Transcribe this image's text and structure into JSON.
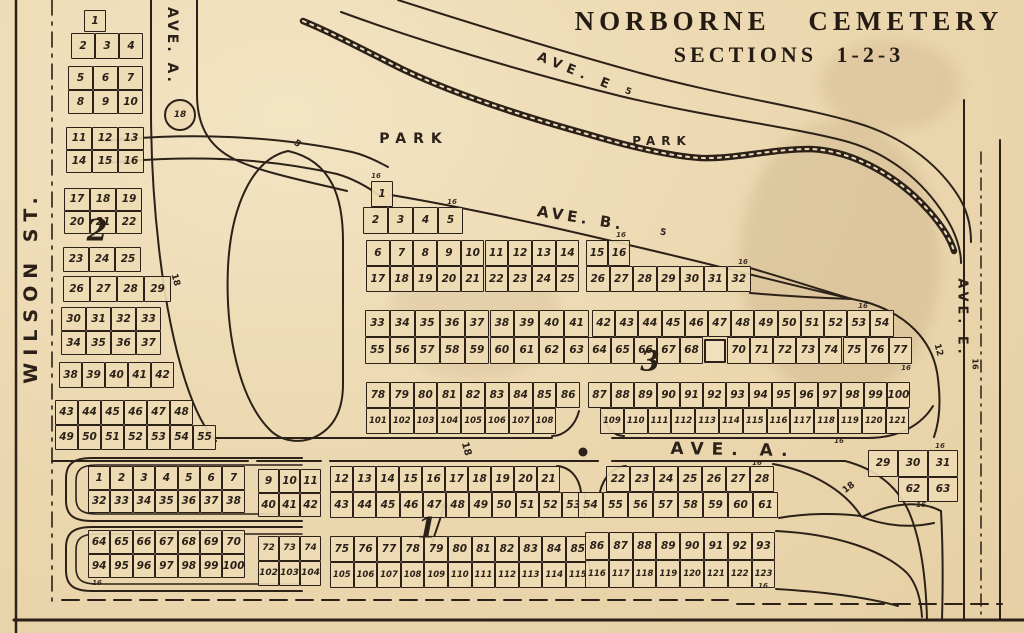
{
  "title": {
    "line1": "NORBORNE CEMETERY",
    "line2": "SECTIONS 1-2-3"
  },
  "colors": {
    "paper": "#ecd8b0",
    "ink": "#2b2118"
  },
  "markers": {
    "circle18": "18"
  },
  "labels": [
    {
      "id": "wilson-st-label",
      "text": "WILSON ST.",
      "x": 31,
      "y": 287,
      "rot": -90,
      "fs": 19,
      "ls": 7
    },
    {
      "id": "ave-a-north-label",
      "text": "AVE. A.",
      "x": 172,
      "y": 46,
      "rot": 90,
      "fs": 14,
      "ls": 3
    },
    {
      "id": "ave-e-top-label",
      "text": "AVE. E",
      "x": 576,
      "y": 72,
      "rot": 22,
      "fs": 13,
      "ls": 6
    },
    {
      "id": "ave-e-top-width",
      "text": "5",
      "x": 628,
      "y": 92,
      "rot": 22,
      "fs": 9
    },
    {
      "id": "park-west-label",
      "text": "PARK",
      "x": 414,
      "y": 139,
      "rot": 0,
      "fs": 14,
      "ls": 7
    },
    {
      "id": "park-east-label",
      "text": "PARK",
      "x": 662,
      "y": 141,
      "rot": 0,
      "fs": 12,
      "ls": 6
    },
    {
      "id": "ave-b-label",
      "text": "AVE. B.",
      "x": 581,
      "y": 218,
      "rot": 9,
      "fs": 15,
      "ls": 4
    },
    {
      "id": "ave-b-width",
      "text": "5",
      "x": 663,
      "y": 233,
      "rot": 12,
      "fs": 9
    },
    {
      "id": "park-road-width",
      "text": "5",
      "x": 297,
      "y": 144,
      "rot": 35,
      "fs": 9
    },
    {
      "id": "ave-a-main-label",
      "text": "AVE.  A.",
      "x": 733,
      "y": 450,
      "rot": 1,
      "fs": 17,
      "ls": 8
    },
    {
      "id": "ave-e-right-label",
      "text": "AVE. E.",
      "x": 962,
      "y": 318,
      "rot": 90,
      "fs": 13,
      "ls": 4
    },
    {
      "id": "ave-e-right-width",
      "text": "16",
      "x": 975,
      "y": 364,
      "rot": 90,
      "fs": 8
    },
    {
      "id": "road-width-18-left",
      "text": "18",
      "x": 175,
      "y": 280,
      "rot": 75,
      "fs": 9
    },
    {
      "id": "road-width-18-avea",
      "text": "18",
      "x": 466,
      "y": 449,
      "rot": 75,
      "fs": 10
    },
    {
      "id": "road-width-18-se",
      "text": "18",
      "x": 849,
      "y": 488,
      "rot": -38,
      "fs": 9
    },
    {
      "id": "road-width-12-right",
      "text": "12",
      "x": 938,
      "y": 350,
      "rot": 75,
      "fs": 9
    },
    {
      "id": "section-2-numeral",
      "text": "2",
      "x": 97,
      "y": 231,
      "rot": 0,
      "fs": 30,
      "cls": "numeral"
    },
    {
      "id": "section-3-numeral",
      "text": "3",
      "x": 650,
      "y": 361,
      "rot": 0,
      "fs": 28,
      "cls": "numeral"
    },
    {
      "id": "section-1-numeral",
      "text": "1",
      "x": 427,
      "y": 528,
      "rot": 0,
      "fs": 28,
      "cls": "numeral"
    },
    {
      "id": "lot-width-tick",
      "text": "16",
      "x": 376,
      "y": 176,
      "rot": 0,
      "fs": 7,
      "cls": "tick"
    },
    {
      "id": "lot-width-tick",
      "text": "16",
      "x": 452,
      "y": 202,
      "rot": 0,
      "fs": 7,
      "cls": "tick"
    },
    {
      "id": "lot-width-tick",
      "text": "16",
      "x": 621,
      "y": 235,
      "rot": 0,
      "fs": 7,
      "cls": "tick"
    },
    {
      "id": "lot-width-tick",
      "text": "16",
      "x": 743,
      "y": 262,
      "rot": 0,
      "fs": 7,
      "cls": "tick"
    },
    {
      "id": "lot-width-tick",
      "text": "16",
      "x": 863,
      "y": 306,
      "rot": 0,
      "fs": 7,
      "cls": "tick"
    },
    {
      "id": "lot-width-tick",
      "text": "16",
      "x": 906,
      "y": 368,
      "rot": 0,
      "fs": 7,
      "cls": "tick"
    },
    {
      "id": "lot-width-tick",
      "text": "16",
      "x": 839,
      "y": 441,
      "rot": 0,
      "fs": 7,
      "cls": "tick"
    },
    {
      "id": "lot-width-tick",
      "text": "16",
      "x": 757,
      "y": 463,
      "rot": 0,
      "fs": 7,
      "cls": "tick"
    },
    {
      "id": "lot-width-tick",
      "text": "16",
      "x": 940,
      "y": 446,
      "rot": 0,
      "fs": 7,
      "cls": "tick"
    },
    {
      "id": "lot-width-tick",
      "text": "16",
      "x": 921,
      "y": 505,
      "rot": 0,
      "fs": 7,
      "cls": "tick"
    },
    {
      "id": "lot-width-tick",
      "text": "16",
      "x": 763,
      "y": 586,
      "rot": 0,
      "fs": 7,
      "cls": "tick"
    },
    {
      "id": "lot-width-tick",
      "text": "16",
      "x": 97,
      "y": 583,
      "rot": 0,
      "fs": 7,
      "cls": "tick"
    }
  ],
  "grids": [
    {
      "id": "sec2-block-a",
      "x": 84,
      "y": 10,
      "cw": 22,
      "ch": 22,
      "rows": [
        [
          "1"
        ]
      ]
    },
    {
      "id": "sec2-block-b",
      "x": 71,
      "y": 33,
      "cw": 24,
      "ch": 26,
      "rows": [
        [
          "2",
          "3",
          "4"
        ]
      ]
    },
    {
      "id": "sec2-block-c",
      "x": 68,
      "y": 66,
      "cw": 25,
      "ch": 24,
      "rows": [
        [
          "5",
          "6",
          "7"
        ],
        [
          "8",
          "9",
          "10"
        ]
      ]
    },
    {
      "id": "sec2-block-d",
      "x": 66,
      "y": 127,
      "cw": 26,
      "ch": 23,
      "rows": [
        [
          "11",
          "12",
          "13"
        ],
        [
          "14",
          "15",
          "16"
        ]
      ]
    },
    {
      "id": "sec2-block-e",
      "x": 64,
      "y": 188,
      "cw": 26,
      "ch": 23,
      "rows": [
        [
          "17",
          "18",
          "19"
        ],
        [
          "20",
          "21",
          "22"
        ]
      ]
    },
    {
      "id": "sec2-block-f",
      "x": 63,
      "y": 247,
      "cw": 26,
      "ch": 25,
      "rows": [
        [
          "23",
          "24",
          "25"
        ]
      ]
    },
    {
      "id": "sec2-block-g",
      "x": 63,
      "y": 276,
      "cw": 27,
      "ch": 26,
      "rows": [
        [
          "26",
          "27",
          "28",
          "29"
        ]
      ]
    },
    {
      "id": "sec2-block-h",
      "x": 61,
      "y": 307,
      "cw": 25,
      "ch": 24,
      "rows": [
        [
          "30",
          "31",
          "32",
          "33"
        ],
        [
          "34",
          "35",
          "36",
          "37"
        ]
      ]
    },
    {
      "id": "sec2-block-i",
      "x": 59,
      "y": 362,
      "cw": 23,
      "ch": 26,
      "rows": [
        [
          "38",
          "39",
          "40",
          "41",
          "42"
        ]
      ]
    },
    {
      "id": "sec2-block-j",
      "x": 55,
      "y": 400,
      "cw": 23,
      "ch": 25,
      "rows": [
        [
          "43",
          "44",
          "45",
          "46",
          "47",
          "48"
        ]
      ]
    },
    {
      "id": "sec2-block-k",
      "x": 55,
      "y": 425,
      "cw": 23,
      "ch": 25,
      "rows": [
        [
          "49",
          "50",
          "51",
          "52",
          "53",
          "54",
          "55"
        ]
      ]
    },
    {
      "id": "sec3-lot-1",
      "x": 371,
      "y": 181,
      "cw": 22,
      "ch": 26,
      "rows": [
        [
          "1"
        ]
      ]
    },
    {
      "id": "sec3-row-2-5",
      "x": 363,
      "y": 207,
      "cw": 25,
      "ch": 27,
      "rows": [
        [
          "2",
          "3",
          "4",
          "5"
        ]
      ]
    },
    {
      "id": "sec3-band1-left",
      "x": 366,
      "y": 240,
      "cw": 23.7,
      "ch": 26,
      "rows": [
        [
          "6",
          "7",
          "8",
          "9",
          "10",
          "11",
          "12",
          "13",
          "14"
        ],
        [
          "17",
          "18",
          "19",
          "20",
          "21",
          "22",
          "23",
          "24",
          "25"
        ]
      ]
    },
    {
      "id": "sec3-band1-right-top",
      "x": 586,
      "y": 240,
      "cw": 22,
      "ch": 26,
      "rows": [
        [
          "15",
          "16"
        ]
      ]
    },
    {
      "id": "sec3-band1-right-bot",
      "x": 586,
      "y": 266,
      "cw": 23.5,
      "ch": 26,
      "rows": [
        [
          "26",
          "27",
          "28",
          "29",
          "30",
          "31",
          "32"
        ]
      ]
    },
    {
      "id": "sec3-band2-left",
      "x": 365,
      "y": 310,
      "cw": 24.9,
      "ch": 27,
      "rows": [
        [
          "33",
          "34",
          "35",
          "36",
          "37",
          "38",
          "39",
          "40",
          "41"
        ],
        [
          "55",
          "56",
          "57",
          "58",
          "59",
          "60",
          "61",
          "62",
          "63"
        ]
      ]
    },
    {
      "id": "sec3-band2-right-top",
      "x": 592,
      "y": 310,
      "cw": 23.2,
      "ch": 27,
      "rows": [
        [
          "42",
          "43",
          "44",
          "45",
          "46",
          "47",
          "48",
          "49",
          "50",
          "51",
          "52",
          "53",
          "54"
        ]
      ]
    },
    {
      "id": "sec3-band2-right-bot-a",
      "x": 588,
      "y": 337,
      "cw": 23,
      "ch": 27,
      "rows": [
        [
          "64",
          "65",
          "66",
          "67",
          "68"
        ]
      ]
    },
    {
      "id": "sec3-structure",
      "x": 704,
      "y": 339,
      "cw": 22,
      "ch": 24,
      "thick": true,
      "rows": [
        [
          ""
        ]
      ]
    },
    {
      "id": "sec3-band2-right-bot-b",
      "x": 727,
      "y": 337,
      "cw": 23.1,
      "ch": 27,
      "rows": [
        [
          "70",
          "71",
          "72",
          "73",
          "74",
          "75",
          "76",
          "77"
        ]
      ]
    },
    {
      "id": "sec3-band3-left-top",
      "x": 366,
      "y": 382,
      "cw": 23.8,
      "ch": 26,
      "rows": [
        [
          "78",
          "79",
          "80",
          "81",
          "82",
          "83",
          "84",
          "85",
          "86"
        ]
      ]
    },
    {
      "id": "sec3-band3-left-bot",
      "x": 366,
      "y": 408,
      "cw": 23.8,
      "ch": 26,
      "fs": 8.5,
      "rows": [
        [
          "101",
          "102",
          "103",
          "104",
          "105",
          "106",
          "107",
          "108"
        ]
      ]
    },
    {
      "id": "sec3-band3-right-top",
      "x": 588,
      "y": 382,
      "cw": 23,
      "ch": 26,
      "rows": [
        [
          "87",
          "88",
          "89",
          "90",
          "91",
          "92",
          "93",
          "94",
          "95",
          "96",
          "97",
          "98",
          "99",
          "100"
        ]
      ]
    },
    {
      "id": "sec3-band3-right-bot",
      "x": 600,
      "y": 408,
      "cw": 23.8,
      "ch": 26,
      "fs": 8.5,
      "rows": [
        [
          "109",
          "110",
          "111",
          "112",
          "113",
          "114",
          "115",
          "116",
          "117",
          "118",
          "119",
          "120",
          "121"
        ]
      ]
    },
    {
      "id": "sec1-west-block1",
      "x": 88,
      "y": 466,
      "cw": 22.4,
      "ch": 23.5,
      "rows": [
        [
          "1",
          "2",
          "3",
          "4",
          "5",
          "6",
          "7"
        ],
        [
          "32",
          "33",
          "34",
          "35",
          "36",
          "37",
          "38"
        ]
      ]
    },
    {
      "id": "sec1-west-block2",
      "x": 88,
      "y": 530,
      "cw": 22.4,
      "ch": 24,
      "rows": [
        [
          "64",
          "65",
          "66",
          "67",
          "68",
          "69",
          "70"
        ],
        [
          "94",
          "95",
          "96",
          "97",
          "98",
          "99",
          "100"
        ]
      ]
    },
    {
      "id": "sec1-mid-block1",
      "x": 258,
      "y": 469,
      "cw": 21,
      "ch": 24,
      "rows": [
        [
          "9",
          "10",
          "11"
        ],
        [
          "40",
          "41",
          "42"
        ]
      ]
    },
    {
      "id": "sec1-mid-row-12-21",
      "x": 330,
      "y": 466,
      "cw": 23,
      "ch": 26,
      "rows": [
        [
          "12",
          "13",
          "14",
          "15",
          "16",
          "17",
          "18",
          "19",
          "20",
          "21"
        ]
      ]
    },
    {
      "id": "sec1-mid-row-43-53",
      "x": 330,
      "y": 492,
      "cw": 23.2,
      "ch": 26,
      "rows": [
        [
          "43",
          "44",
          "45",
          "46",
          "47",
          "48",
          "49",
          "50",
          "51",
          "52",
          "53"
        ]
      ]
    },
    {
      "id": "sec1-mid-block2",
      "x": 258,
      "y": 536,
      "cw": 21,
      "ch": 25,
      "fs": 9,
      "rows": [
        [
          "72",
          "73",
          "74"
        ],
        [
          "102",
          "103",
          "104"
        ]
      ]
    },
    {
      "id": "sec1-mid-row-75-85",
      "x": 330,
      "y": 536,
      "cw": 23.6,
      "ch": 26,
      "rows": [
        [
          "75",
          "76",
          "77",
          "78",
          "79",
          "80",
          "81",
          "82",
          "83",
          "84",
          "85"
        ]
      ]
    },
    {
      "id": "sec1-mid-row-105-115",
      "x": 330,
      "y": 562,
      "cw": 23.6,
      "ch": 26,
      "fs": 8.5,
      "rows": [
        [
          "105",
          "106",
          "107",
          "108",
          "109",
          "110",
          "111",
          "112",
          "113",
          "114",
          "115"
        ]
      ]
    },
    {
      "id": "sec1-right-row-22-28",
      "x": 606,
      "y": 466,
      "cw": 24,
      "ch": 26,
      "rows": [
        [
          "22",
          "23",
          "24",
          "25",
          "26",
          "27",
          "28"
        ]
      ]
    },
    {
      "id": "sec1-right-row-54-61",
      "x": 578,
      "y": 492,
      "cw": 25,
      "ch": 26,
      "rows": [
        [
          "54",
          "55",
          "56",
          "57",
          "58",
          "59",
          "60",
          "61"
        ]
      ]
    },
    {
      "id": "sec1-right-row-86-93",
      "x": 585,
      "y": 532,
      "cw": 23.8,
      "ch": 28,
      "rows": [
        [
          "86",
          "87",
          "88",
          "89",
          "90",
          "91",
          "92",
          "93"
        ]
      ]
    },
    {
      "id": "sec1-right-row-116-123",
      "x": 585,
      "y": 560,
      "cw": 23.8,
      "ch": 28,
      "fs": 8.5,
      "rows": [
        [
          "116",
          "117",
          "118",
          "119",
          "120",
          "121",
          "122",
          "123"
        ]
      ]
    },
    {
      "id": "sec1-triangle-top",
      "x": 868,
      "y": 450,
      "cw": 30,
      "ch": 27,
      "rows": [
        [
          "29",
          "30",
          "31"
        ]
      ]
    },
    {
      "id": "sec1-triangle-bot",
      "x": 898,
      "y": 477,
      "cw": 30,
      "ch": 25,
      "rows": [
        [
          "62",
          "63"
        ]
      ]
    }
  ]
}
